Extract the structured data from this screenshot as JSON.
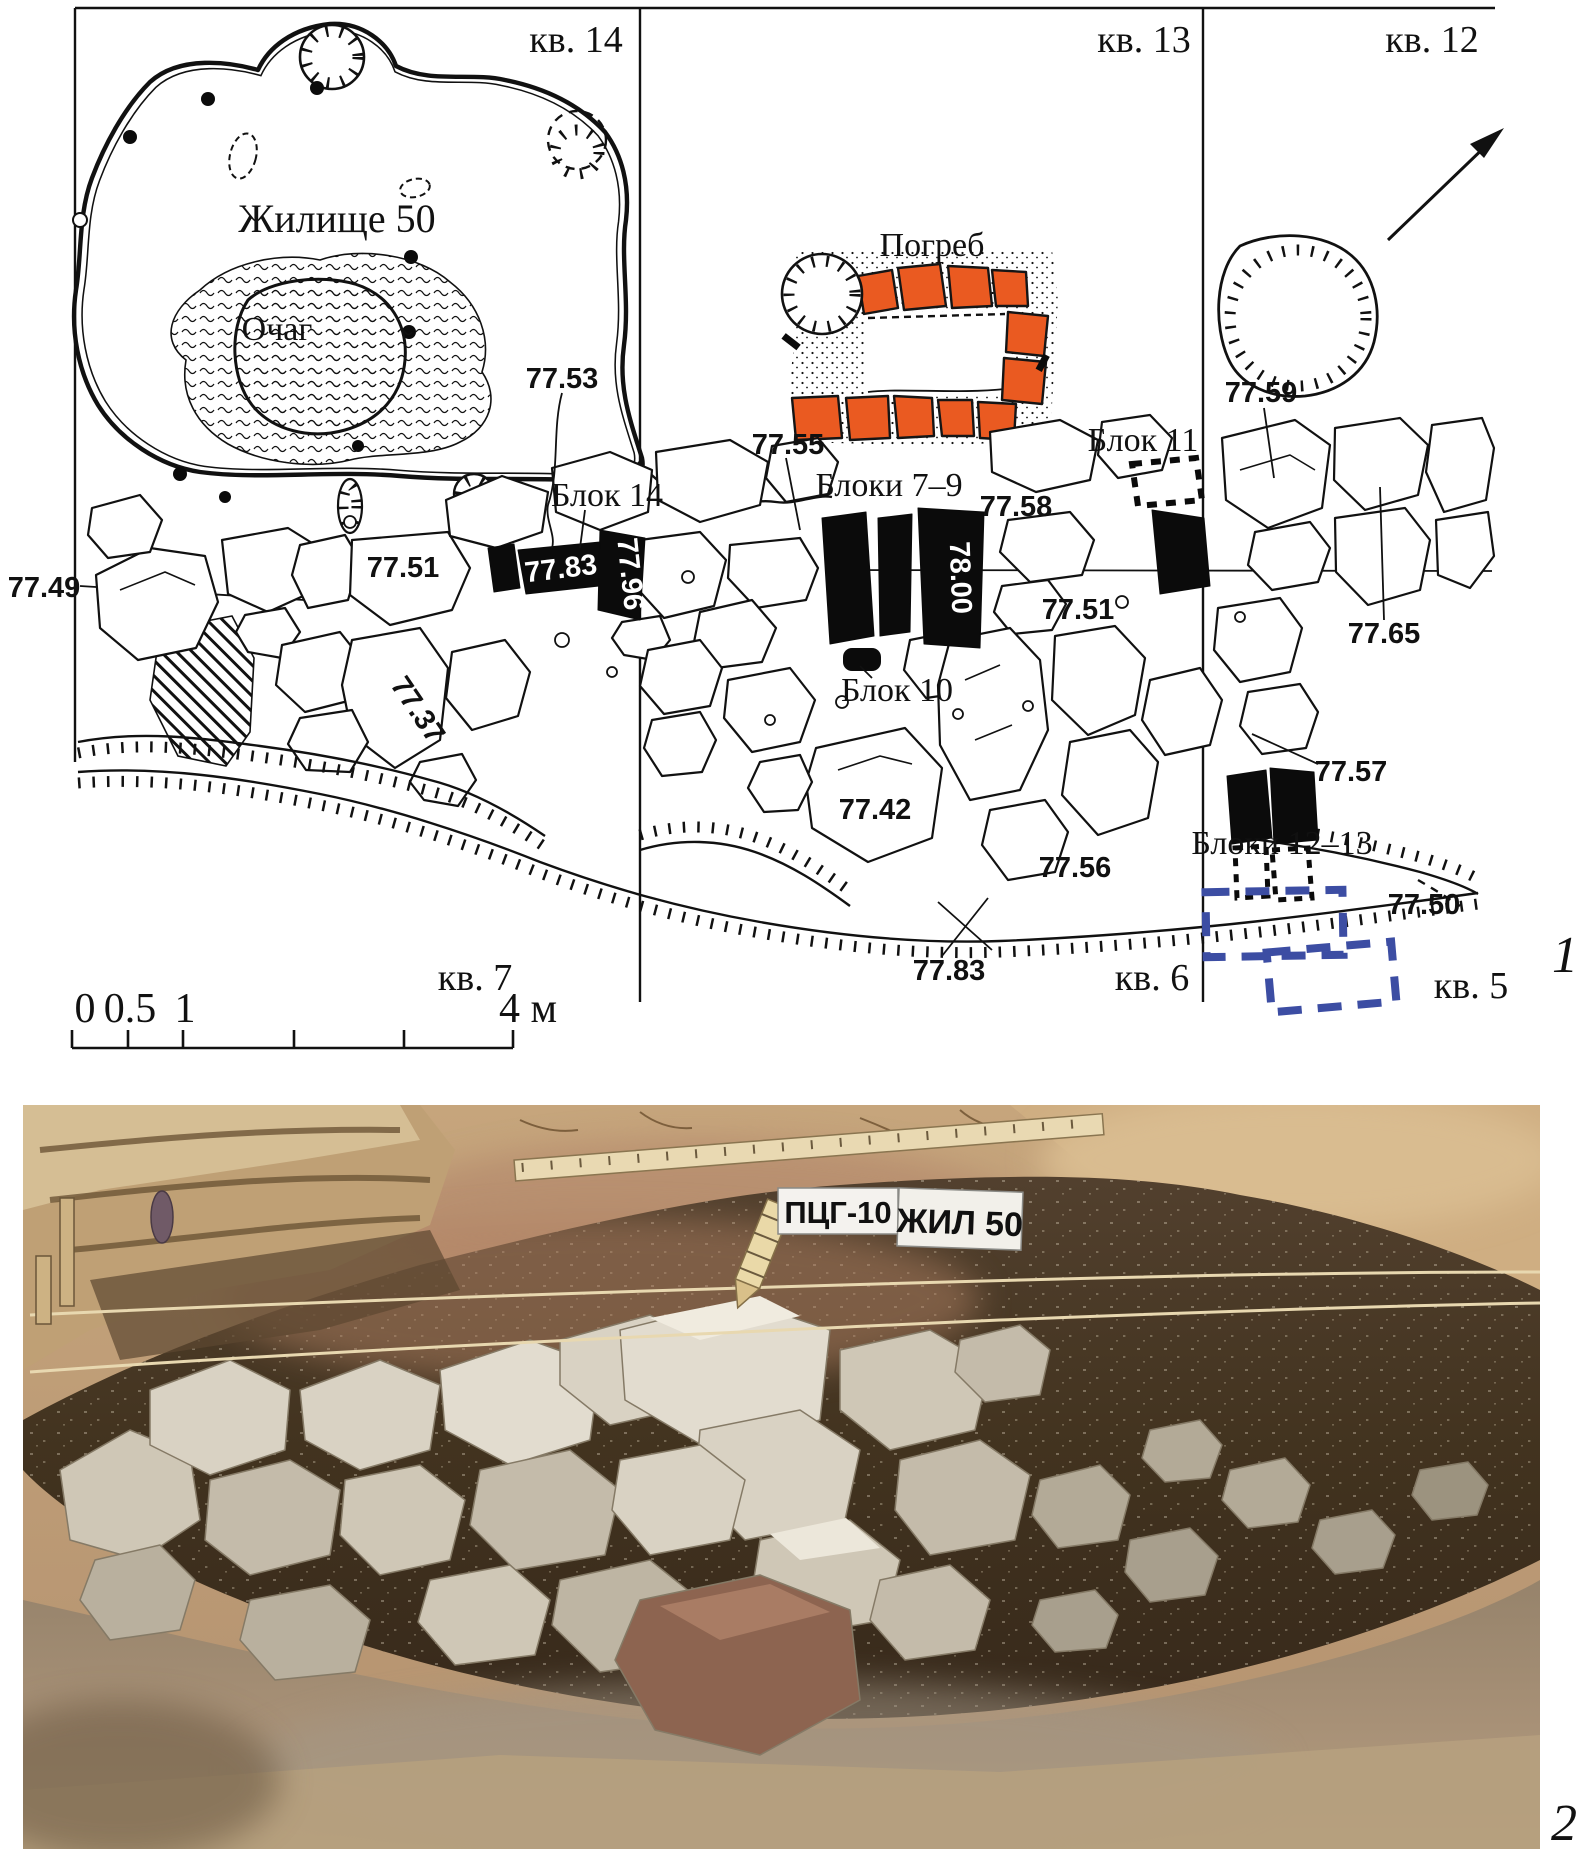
{
  "figure": {
    "part1_number": "1",
    "part2_number": "2"
  },
  "plan": {
    "quads": {
      "q14": "кв. 14",
      "q13": "кв. 13",
      "q12": "кв. 12",
      "q7": "кв. 7",
      "q6": "кв. 6",
      "q5": "кв. 5"
    },
    "features": {
      "dwelling": "Жилище 50",
      "hearth": "Очаг",
      "cellar": "Погреб",
      "block14": "Блок 14",
      "blocks7_9": "Блоки 7–9",
      "block10": "Блок 10",
      "block11": "Блок 11",
      "blocks12_13": "Блоки 12–13"
    },
    "elev": {
      "e77_49": "77.49",
      "e77_51a": "77.51",
      "e77_51b": "77.51",
      "e77_53": "77.53",
      "e77_55": "77.55",
      "e77_56": "77.56",
      "e77_57": "77.57",
      "e77_58": "77.58",
      "e77_59": "77.59",
      "e77_37": "77.37",
      "e77_42": "77.42",
      "e77_50": "77.50",
      "e77_65": "77.65",
      "e77_83_block": "77.83",
      "e77_96_block": "77.96",
      "e78_00_block": "78.00",
      "e77_83_edge": "77.83"
    },
    "scale_bar": {
      "t0": "0",
      "t05": "0.5",
      "t1": "1",
      "t4": "4 м"
    },
    "colors": {
      "cellar_orange": "#ea5a21",
      "test_pit_blue": "#3c4da3"
    }
  },
  "photo": {
    "sign_site": "ПЦГ-10",
    "sign_object": "ЖИЛ 50"
  }
}
